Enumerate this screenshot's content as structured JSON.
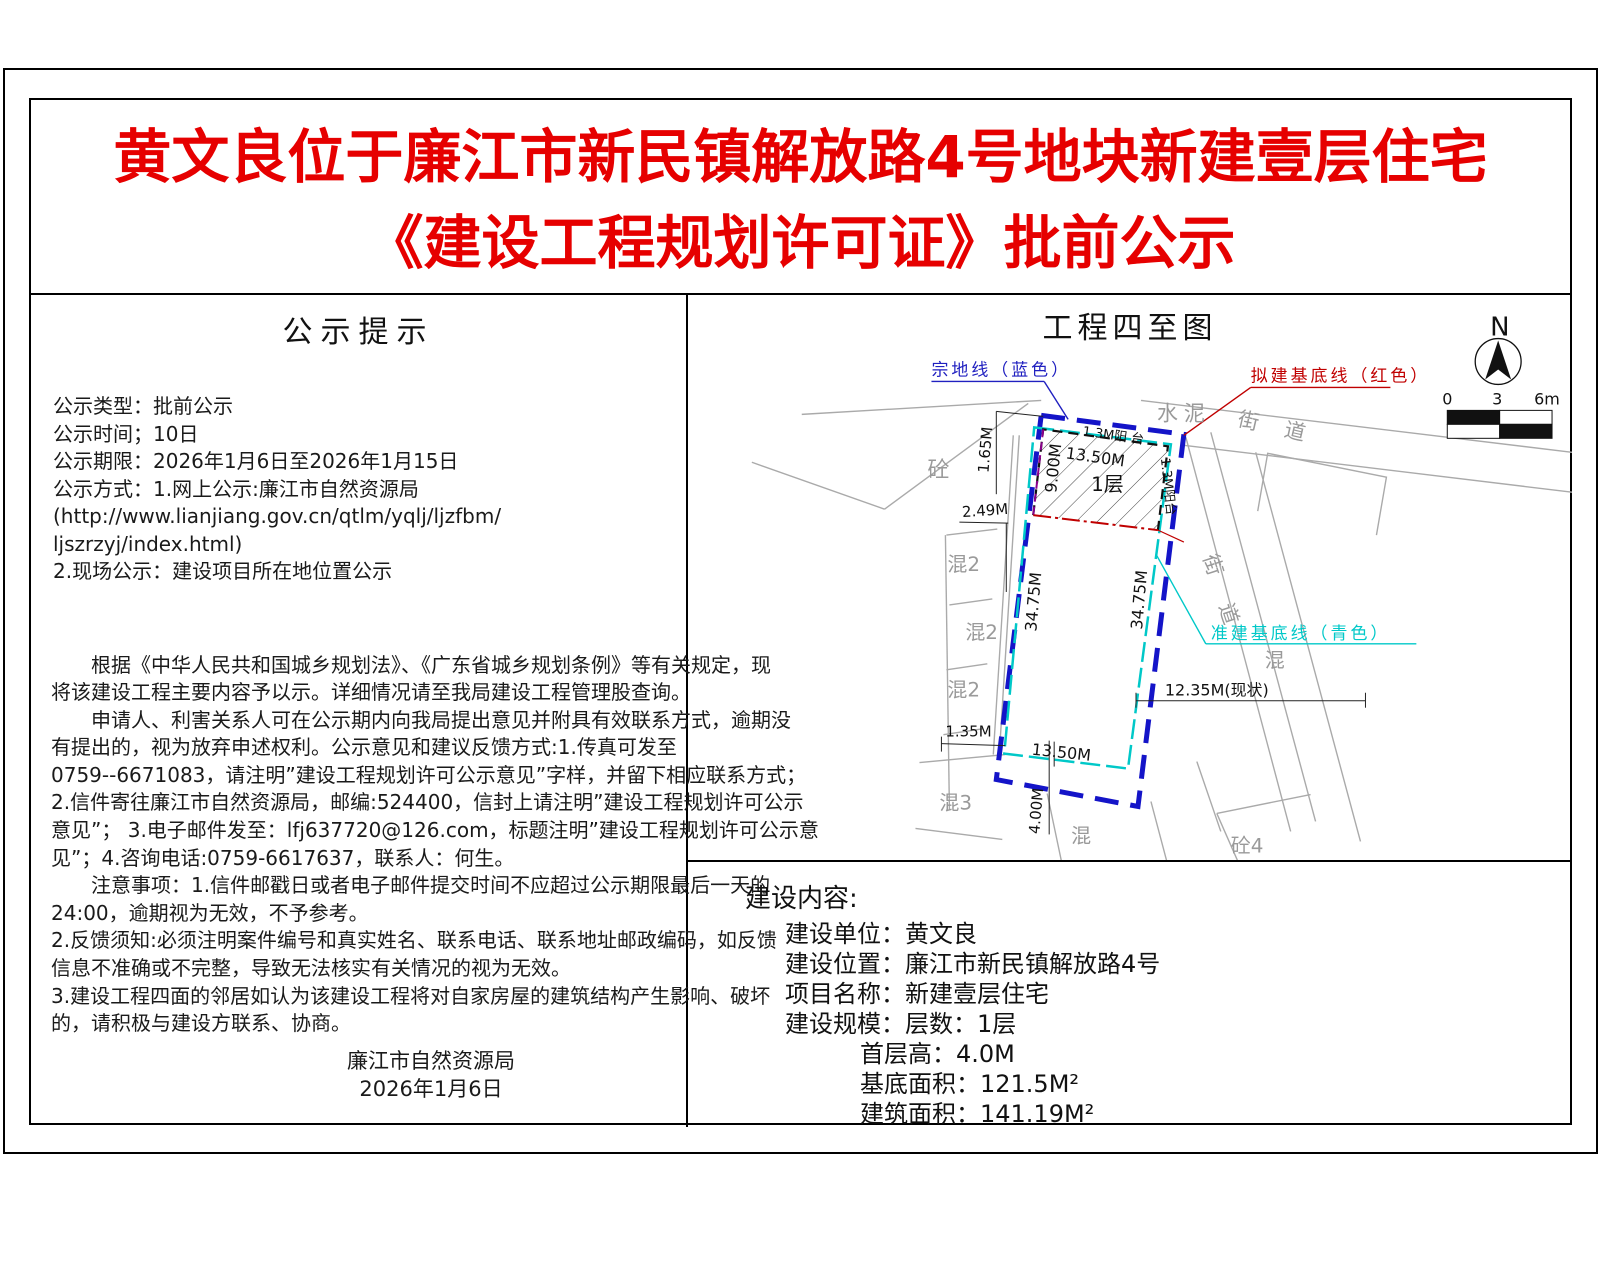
{
  "page_title": {
    "line1": "黄文良位于廉江市新民镇解放路4号地块新建壹层住宅",
    "line2": "《建设工程规划许可证》批前公示"
  },
  "notice": {
    "heading": "公示提示",
    "info_lines": [
      "公示类型：批前公示",
      "公示时间；10日",
      "公示期限：2026年1月6日至2026年1月15日",
      "公示方式：1.网上公示:廉江市自然资源局",
      "(http://www.lianjiang.gov.cn/qtlm/yqlj/ljzfbm/",
      " ljszrzyj/index.html)",
      "2.现场公示：建设项目所在地位置公示"
    ],
    "body_lines": [
      "　　根据《中华人民共和国城乡规划法》、《广东省城乡规划条例》等有关规定，现",
      "将该建设工程主要内容予以示。详细情况请至我局建设工程管理股查询。",
      "　　申请人、利害关系人可在公示期内向我局提出意见并附具有效联系方式，逾期没",
      "有提出的，视为放弃申述权利。公示意见和建议反馈方式:1.传真可发至",
      "0759--6671083，请注明”建设工程规划许可公示意见”字样，并留下相应联系方式；",
      "2.信件寄往廉江市自然资源局，邮编:524400，信封上请注明”建设工程规划许可公示",
      "意见”； 3.电子邮件发至：lfj637720@126.com，标题注明”建设工程规划许可公示意",
      "见”；4.咨询电话:0759-6617637，联系人：何生。",
      "　　注意事项：1.信件邮戳日或者电子邮件提交时间不应超过公示期限最后一天的",
      "24:00，逾期视为无效，不予参考。",
      "2.反馈须知:必须注明案件编号和真实姓名、联系电话、联系地址邮政编码，如反馈",
      "信息不准确或不完整，导致无法核实有关情况的视为无效。",
      "3.建设工程四面的邻居如认为该建设工程将对自家房屋的建筑结构产生影响、破坏",
      "的，请积极与建设方联系、协商。"
    ],
    "signature": "廉江市自然资源局",
    "signature_date": "2026年1月6日"
  },
  "map": {
    "heading": "工程四至图",
    "legend": {
      "parcel_line": "宗地线（蓝色）",
      "proposed_base": "拟建基底线（红色）",
      "approved_base": "准建基底线（青色）"
    },
    "compass_n": "N",
    "scale_ticks": [
      "0",
      "3",
      "6m"
    ],
    "labels": {
      "shuini": "水泥",
      "jiedao_top": "街 道",
      "jiedao_right": "街 道",
      "tong": "砼",
      "hun2": [
        "混2",
        "混2",
        "混2"
      ],
      "hun3": "混3",
      "hun_bottom": "混",
      "hun_right": "混",
      "tong4": "砼4",
      "floor": "1层",
      "balcony_top": "1.3M阳 台",
      "balcony_right": "1.3M阳台"
    },
    "dims": {
      "d165": "1.65M",
      "d249": "2.49M",
      "d900": "9.00M",
      "d1350": [
        "13.50M",
        "13.50M"
      ],
      "d3475": [
        "34.75M",
        "34.75M"
      ],
      "d1235": "12.35M(现状)",
      "d135": "1.35M",
      "d400": "4.00M"
    },
    "colors": {
      "parcel_blue": "#1414c8",
      "base_red": "#c00000",
      "approved_cyan": "#00c8c8",
      "neighbor_gray": "#aaaaaa",
      "title_red": "#e60000"
    }
  },
  "content": {
    "heading": "建设内容:",
    "rows": [
      "建设单位：黄文良",
      "建设位置：廉江市新民镇解放路4号",
      "项目名称：新建壹层住宅",
      "建设规模：层数：1层",
      "首层高：4.0M",
      "基底面积：121.5M²",
      "建筑面积：141.19M²"
    ]
  }
}
